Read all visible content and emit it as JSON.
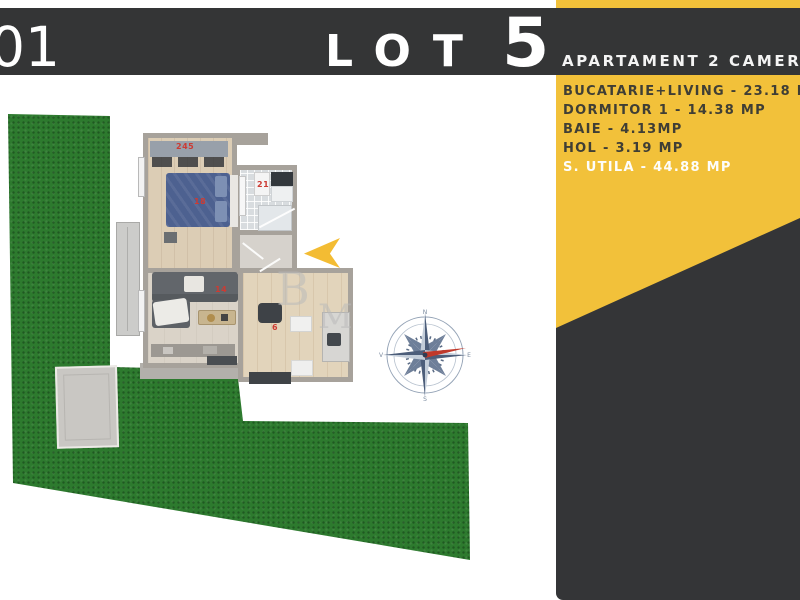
{
  "header": {
    "unit_number": "01",
    "lot_label": "LOT",
    "lot_number": "5",
    "subtitle": "APARTAMENT 2 CAMERE"
  },
  "room_list": {
    "items": [
      {
        "label": "BUCATARIE+LIVING - 23.18 MP",
        "highlighted": false
      },
      {
        "label": "DORMITOR 1 - 14.38 MP",
        "highlighted": false
      },
      {
        "label": "BAIE - 4.13MP",
        "highlighted": false
      },
      {
        "label": "HOL - 3.19 MP",
        "highlighted": false
      },
      {
        "label": "S. UTILA - 44.88 MP",
        "highlighted": true
      }
    ]
  },
  "floor_plan": {
    "labels": {
      "wardrobe": "245",
      "bed": "18",
      "bathroom": "21",
      "sofa": "14",
      "dining": "6"
    },
    "watermark": {
      "letter_b": "B",
      "letter_m": "M"
    }
  },
  "compass": {
    "north": "N",
    "east": "E",
    "south": "S",
    "west": "V"
  },
  "colors": {
    "accent_yellow": "#F2C13A",
    "panel_dark": "#343537",
    "lawn_green": "#2D7A2E",
    "highlight_gold": "#B49A58",
    "label_red": "#CC3B33",
    "wall_gray": "#A7A29B"
  }
}
